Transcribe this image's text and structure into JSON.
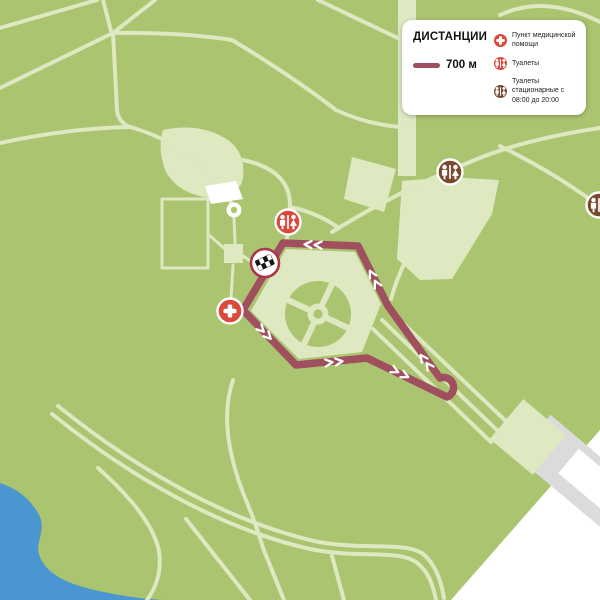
{
  "legend": {
    "title": "ДИСТАНЦИИ",
    "distance": {
      "label": "700 м",
      "line_color": "#a04f5e"
    },
    "items": [
      {
        "icon": "medical-cross-icon",
        "icon_color": "#d9493c",
        "label": "Пункт медицинской помощи"
      },
      {
        "icon": "toilet-icon",
        "icon_color": "#d9493c",
        "label": "Туалеты"
      },
      {
        "icon": "toilet-icon",
        "icon_color": "#7a4a2f",
        "label": "Туалеты стационарные с 08:00 до 20:00"
      }
    ]
  },
  "map": {
    "route": {
      "distance": "700 м",
      "color": "#a04f5e"
    },
    "markers": [
      {
        "type": "finish",
        "icon": "checkered-flag-icon"
      },
      {
        "type": "medical-aid",
        "icon": "medical-cross-icon"
      },
      {
        "type": "toilet",
        "icon": "toilet-icon"
      },
      {
        "type": "toilet-stationary",
        "icon": "toilet-icon"
      },
      {
        "type": "toilet-stationary",
        "icon": "toilet-icon"
      }
    ]
  },
  "colors": {
    "background": "#abc470",
    "path": "#dee8c1",
    "water": "#4b96d0",
    "route": "#a04f5e",
    "building_white": "#ffffff",
    "road_gray": "#dbdbdb",
    "icon_red": "#d9493c",
    "icon_brown": "#7a4a2f",
    "finish_ring": "#aa3648"
  }
}
